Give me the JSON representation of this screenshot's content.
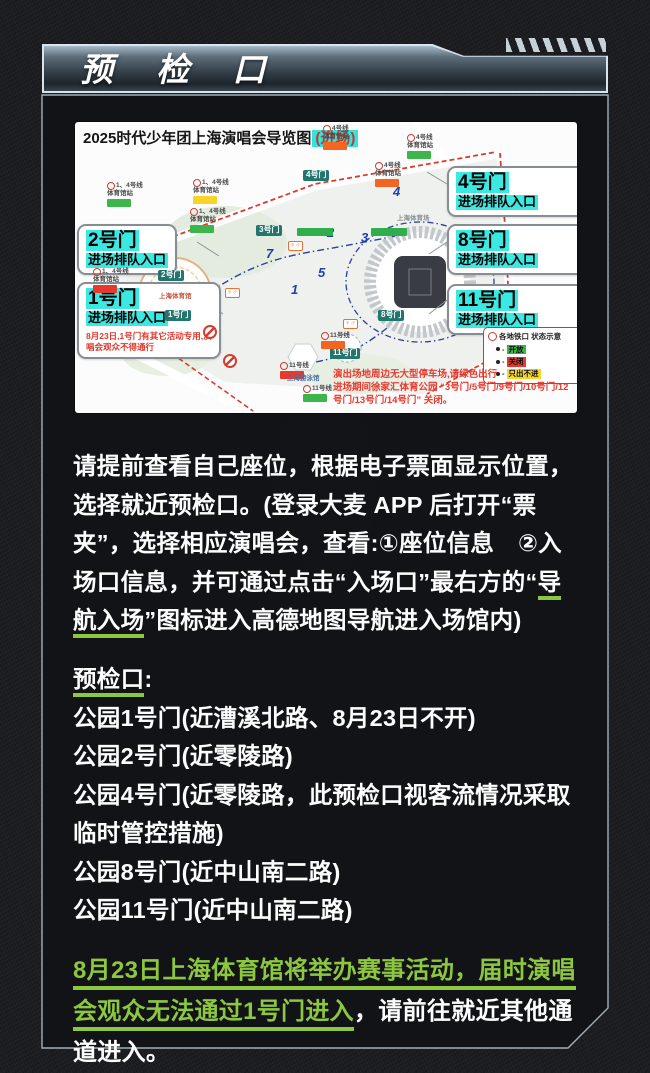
{
  "header": {
    "title": "预 检 口"
  },
  "map": {
    "title": "2025时代少年团上海演唱会导览图",
    "title_highlight": "(进场)",
    "highlight_color": "#35e3dd",
    "callouts": {
      "gate4": {
        "gate": "4号门",
        "label": "进场排队入口"
      },
      "gate8": {
        "gate": "8号门",
        "label": "进场排队入口"
      },
      "gate11": {
        "gate": "11号门",
        "label": "进场排队入口"
      },
      "gate2": {
        "gate": "2号门",
        "label": "进场排队入口"
      },
      "gate1": {
        "gate": "1号门",
        "label": "进场排队入口",
        "note": "8月23日,1号门有其它活动专用,演唱会观众不得通行"
      }
    },
    "gate_tags": [
      "4号门",
      "3号门",
      "2号门",
      "1号门",
      "8号门",
      "11号门"
    ],
    "stations": [
      {
        "line": "4号线",
        "name": "体育馆站",
        "status": "#f26522"
      },
      {
        "line": "4号线",
        "name": "体育馆站",
        "status": "#3cb54a"
      },
      {
        "line": "4号线",
        "name": "体育馆站",
        "status": "#f26522"
      },
      {
        "line": "1、4号线",
        "name": "体育馆站",
        "status": "#3cb54a"
      },
      {
        "line": "1、4号线",
        "name": "体育馆站",
        "status": "#f6d428"
      },
      {
        "line": "1、4号线",
        "name": "体育馆站",
        "status": "#3cb54a"
      },
      {
        "line": "1、4号线",
        "name": "体育馆站",
        "status": "#e8372c"
      },
      {
        "line": "11号线",
        "name": "",
        "status": "#f26522"
      },
      {
        "line": "11号线",
        "name": "",
        "status": "#e8372c"
      },
      {
        "line": "11号线",
        "name": "",
        "status": "#3cb54a"
      }
    ],
    "legend": {
      "title": "各地铁口 状态示意",
      "dash": "-",
      "items": [
        {
          "label": "开放",
          "color": "#3cb54a"
        },
        {
          "label": "关闭",
          "color": "#e8372c"
        },
        {
          "label": "只出不进",
          "color": "#f6d428"
        }
      ]
    },
    "notes": [
      "演出场地周边无大型停车场,请绿色出行",
      "进场期间徐家汇体育公园 “3号门/5号门/9号门/10号门/12号门/13号门/14号门” 关闭。"
    ],
    "venues": {
      "stadium": "上海体育场",
      "arena": "上海体育馆",
      "pool": "上海游泳馆"
    },
    "path_markers": [
      "1",
      "2",
      "3",
      "4",
      "5",
      "7"
    ],
    "icons": {
      "restroom": "♀♂"
    }
  },
  "intro": {
    "segments": [
      {
        "text": "请提前查看自己座位，根据电子票面显示位置，选择就近预检口。(登录大麦 APP 后打开“票夹”，选择相应演唱会，查看:①座位信息　②入场口信息，并可通过点击“入场口”最右方的“"
      },
      {
        "text": "导航入场"
      },
      {
        "text": "”图标进入高德地图导航进入场馆内)"
      }
    ]
  },
  "checkpoints": {
    "heading": "预检口",
    "colon": ":",
    "items": [
      "公园1号门(近漕溪北路、8月23日不开)",
      "公园2号门(近零陵路)",
      "公园4号门(近零陵路，此预检口视客流情况采取临时管控措施)",
      "公园8号门(近中山南二路)",
      "公园11号门(近中山南二路)"
    ]
  },
  "footer": {
    "highlight": "8月23日上海体育馆将举办赛事活动，届时演唱会观众无法通过1号门进入",
    "rest": "，请前往就近其他通道进入。"
  },
  "colors": {
    "accent_green": "#8dc63f",
    "callout_highlight": "#3be9e2",
    "warning_red": "#e8392e",
    "gate_tag_teal": "#23756d"
  }
}
